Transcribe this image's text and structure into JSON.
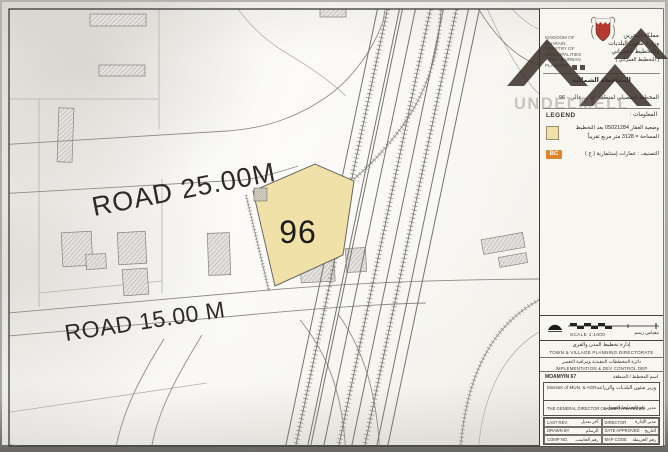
{
  "watermark": {
    "text": "UNDELMELL"
  },
  "map": {
    "plot": {
      "number": "96",
      "fill": "#f0e1a9"
    },
    "roads": [
      {
        "label": "ROAD  25.00M"
      },
      {
        "label": "ROAD 15.00 M"
      }
    ]
  },
  "panel": {
    "header": {
      "en_lines": [
        "KINGDOM OF BAHRAIN",
        "MINISTRY OF MUNICIPALITIES",
        "TOWN & URBAN PLANNING"
      ],
      "ar_lines": [
        "مملكة البحرين",
        "وزارة شئون البلديات",
        "والتخطيط العمراني",
        "( التخطيط العمراني )"
      ],
      "governorate_ar": "المحافظة الشمالية",
      "plan_title_ar": "المخطط التفصيلي لمنطقة جنوب عالي - 96"
    },
    "legend": {
      "heading_en": "LEGEND",
      "heading_ar": "المعلومات :",
      "swatch_color": "#f0e1a9",
      "line1_ar": "وضعية العقار 05021284 بعد التخطيط",
      "line2_ar": "المساحة = 3128 متر مربع تقريباً",
      "badge": "BC",
      "badge_color": "#dd862e",
      "class_ar": "التصنيف : عمارات إستثمارية ( ج )"
    },
    "scale": {
      "label_en": "SCALE   1:1000",
      "label_ar": "مقياس رسم"
    },
    "directorate": {
      "row1_ar": "إدارة تخطيط المدن والقرى",
      "row1_en": "TOWN & VILLAGE PLANNING DIRECTORATE",
      "row2_ar": "دائرة المخططات التنفيذية ومراقبة التعمير",
      "row2_en": "IMPLEMENTATION & DEV CONTROL DEP",
      "row3_left": "MOAMYIN 67",
      "row3_right_ar": "اسم المخطط / المنطقة"
    },
    "signatures": {
      "minister_en": "Minister of MUN. & AGR.",
      "minister_ar": "وزير شئون البلديات والزراعة",
      "director_en": "THE GENERAL DIRECTOR OF URBAN PLANNING",
      "director_ar": "مدير عام التخطيط العمراني"
    },
    "footer_table": {
      "rows": [
        {
          "left_en": "LAST REV.",
          "left_ar": "آخر تعديل",
          "right_en": "DIRECTOR",
          "right_ar": "مدير الإدارة"
        },
        {
          "left_en": "DRAWN BY",
          "left_ar": "الرسام",
          "right_en": "DATE APPROVED",
          "right_ar": "التاريخ"
        },
        {
          "left_en": "COMP NO.",
          "left_ar": "رقم الحاسب",
          "right_en": "MAP CODE",
          "right_ar": "رقم الخريطة"
        }
      ]
    }
  }
}
